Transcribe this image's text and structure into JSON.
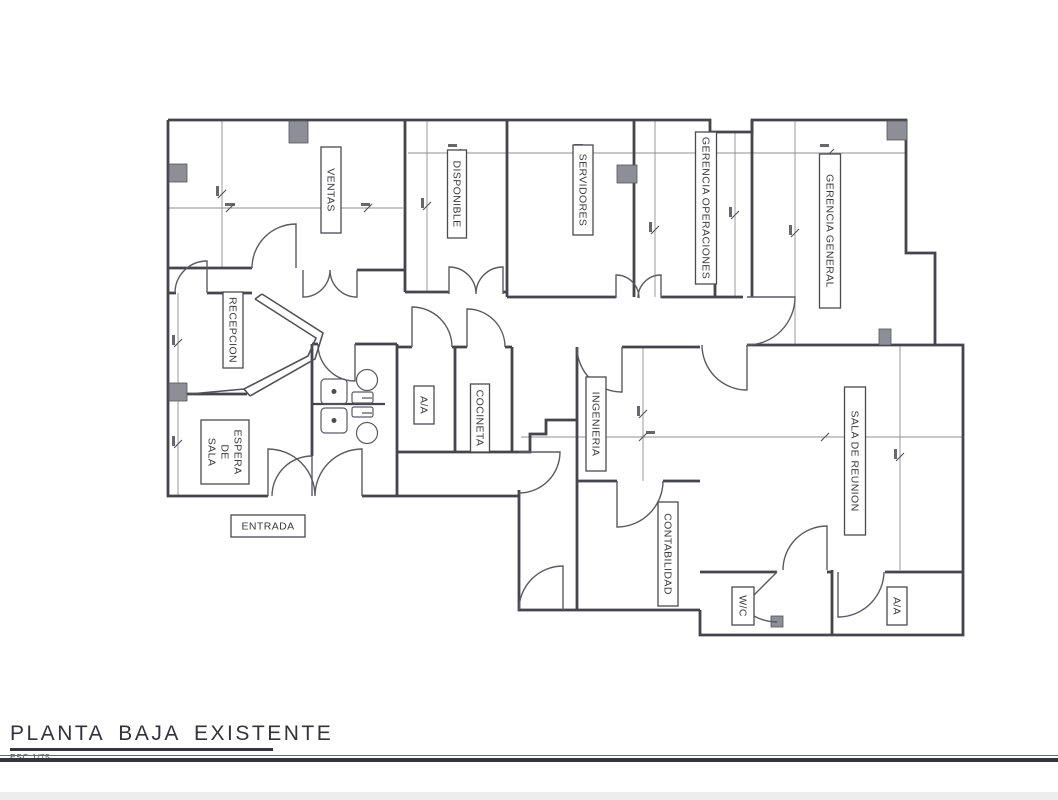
{
  "document": {
    "type": "architectural-floor-plan",
    "language": "es"
  },
  "title_block": {
    "title": "PLANTA BAJA EXISTENTE",
    "scale": "ESC 1/75"
  },
  "plan": {
    "colors": {
      "wall": "#45454d",
      "thin_line": "#8f8f96",
      "column_fill": "#8e8e96",
      "label_text": "#3a3a42",
      "background": "#ffffff"
    },
    "rooms": [
      {
        "id": "ventas",
        "label": "VENTAS",
        "cx": 331,
        "cy": 190,
        "w": 86,
        "h": 20,
        "rot": 90
      },
      {
        "id": "disponible",
        "label": "DISPONIBLE",
        "cx": 457,
        "cy": 194,
        "w": 88,
        "h": 19,
        "rot": 90
      },
      {
        "id": "servidores",
        "label": "SERVIDORES",
        "cx": 583,
        "cy": 190,
        "w": 90,
        "h": 20,
        "rot": 90
      },
      {
        "id": "gerencia-operaciones",
        "label": "GERENCIA OPERACIONES",
        "cx": 706,
        "cy": 208,
        "w": 152,
        "h": 21,
        "rot": 90
      },
      {
        "id": "gerencia-general",
        "label": "GERENCIA GENERAL",
        "cx": 830,
        "cy": 231,
        "w": 154,
        "h": 21,
        "rot": 90
      },
      {
        "id": "recepcion",
        "label": "RECEPCION",
        "cx": 233,
        "cy": 330,
        "w": 76,
        "h": 20,
        "rot": 90
      },
      {
        "id": "sala-de-espera",
        "label": "SALA DE ESPERA",
        "lines": [
          "ESPERA",
          "DE",
          "SALA"
        ],
        "cx": 225,
        "cy": 452,
        "w": 64,
        "h": 48,
        "rot": 90
      },
      {
        "id": "aa-central",
        "label": "A/A",
        "cx": 424,
        "cy": 405,
        "w": 38,
        "h": 20,
        "rot": 90
      },
      {
        "id": "cocineta",
        "label": "COCINETA",
        "cx": 480,
        "cy": 418,
        "w": 68,
        "h": 19,
        "rot": 90
      },
      {
        "id": "ingenieria",
        "label": "INGENIERIA",
        "cx": 596,
        "cy": 424,
        "w": 94,
        "h": 20,
        "rot": 90
      },
      {
        "id": "contabilidad",
        "label": "CONTABILIDAD",
        "cx": 668,
        "cy": 554,
        "w": 104,
        "h": 20,
        "rot": 90
      },
      {
        "id": "sala-de-reunion",
        "label": "SALA DE REUNION",
        "cx": 855,
        "cy": 461,
        "w": 148,
        "h": 21,
        "rot": 90
      },
      {
        "id": "wc",
        "label": "W/C",
        "cx": 743,
        "cy": 606,
        "w": 38,
        "h": 22,
        "rot": 90
      },
      {
        "id": "aa-sureste",
        "label": "A/A",
        "cx": 897,
        "cy": 606,
        "w": 38,
        "h": 20,
        "rot": 90
      },
      {
        "id": "entrada",
        "label": "ENTRADA",
        "cx": 268,
        "cy": 526,
        "w": 74,
        "h": 22,
        "rot": 0
      }
    ]
  }
}
